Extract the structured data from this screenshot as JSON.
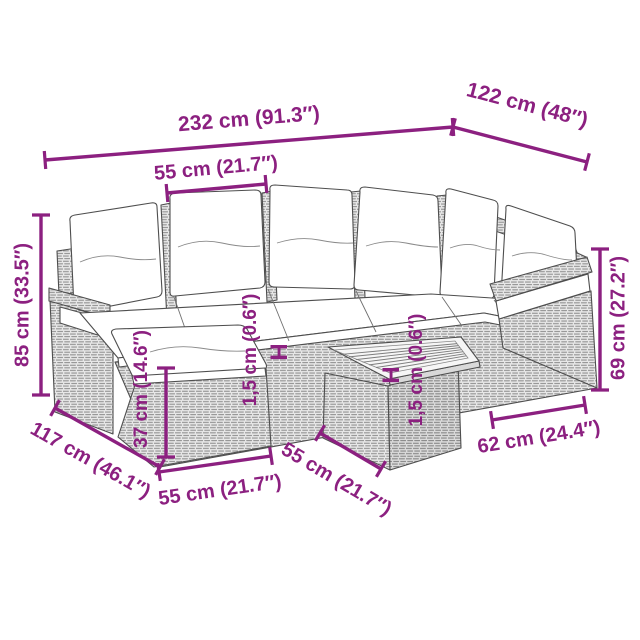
{
  "diagram": {
    "type": "furniture-dimension-diagram",
    "colors": {
      "dimension": "#8C2080",
      "outline": "#4e4e4e",
      "rattan_weave": "#8f8f8f",
      "background": "#ffffff"
    },
    "labels": {
      "total_length": "232 cm (91.3″)",
      "side_depth": "122 cm (48″)",
      "seat_module_width": "55 cm (21.7″)",
      "back_height": "85 cm (33.5″)",
      "ottoman_height": "37 cm (14.6″)",
      "seat_cushion_thickness": "1,5 cm (0.6″)",
      "table_top_thickness": "1,5 cm (0.6″)",
      "total_depth_left": "117 cm (46.1″)",
      "ottoman_width": "55 cm (21.7″)",
      "table_side_width": "55 cm (21.7″)",
      "table_top_width": "62 cm (24.4″)",
      "arm_height_right": "69 cm (27.2″)",
      "height_marker_left": "H",
      "height_marker_right": "H"
    }
  }
}
